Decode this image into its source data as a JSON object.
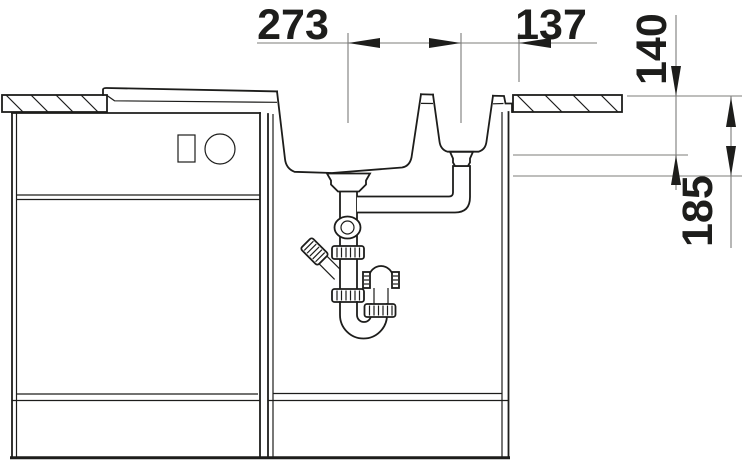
{
  "drawing": {
    "type": "sink-installation-section",
    "description": "Cross-section installation drawing of a kitchen sink with a main bowl and a half bowl set into a countertop above base cabinets, showing the drain trap plumbing and dimensions in millimetres",
    "dimensions": {
      "main_to_small_drain_distance": "273",
      "small_drain_to_edge_distance": "137",
      "small_bowl_depth": "140",
      "main_bowl_depth": "185"
    },
    "colors": {
      "object_line": "#1d1d1b",
      "dimension_line": "#7c7c7a",
      "background": "#ffffff"
    }
  }
}
